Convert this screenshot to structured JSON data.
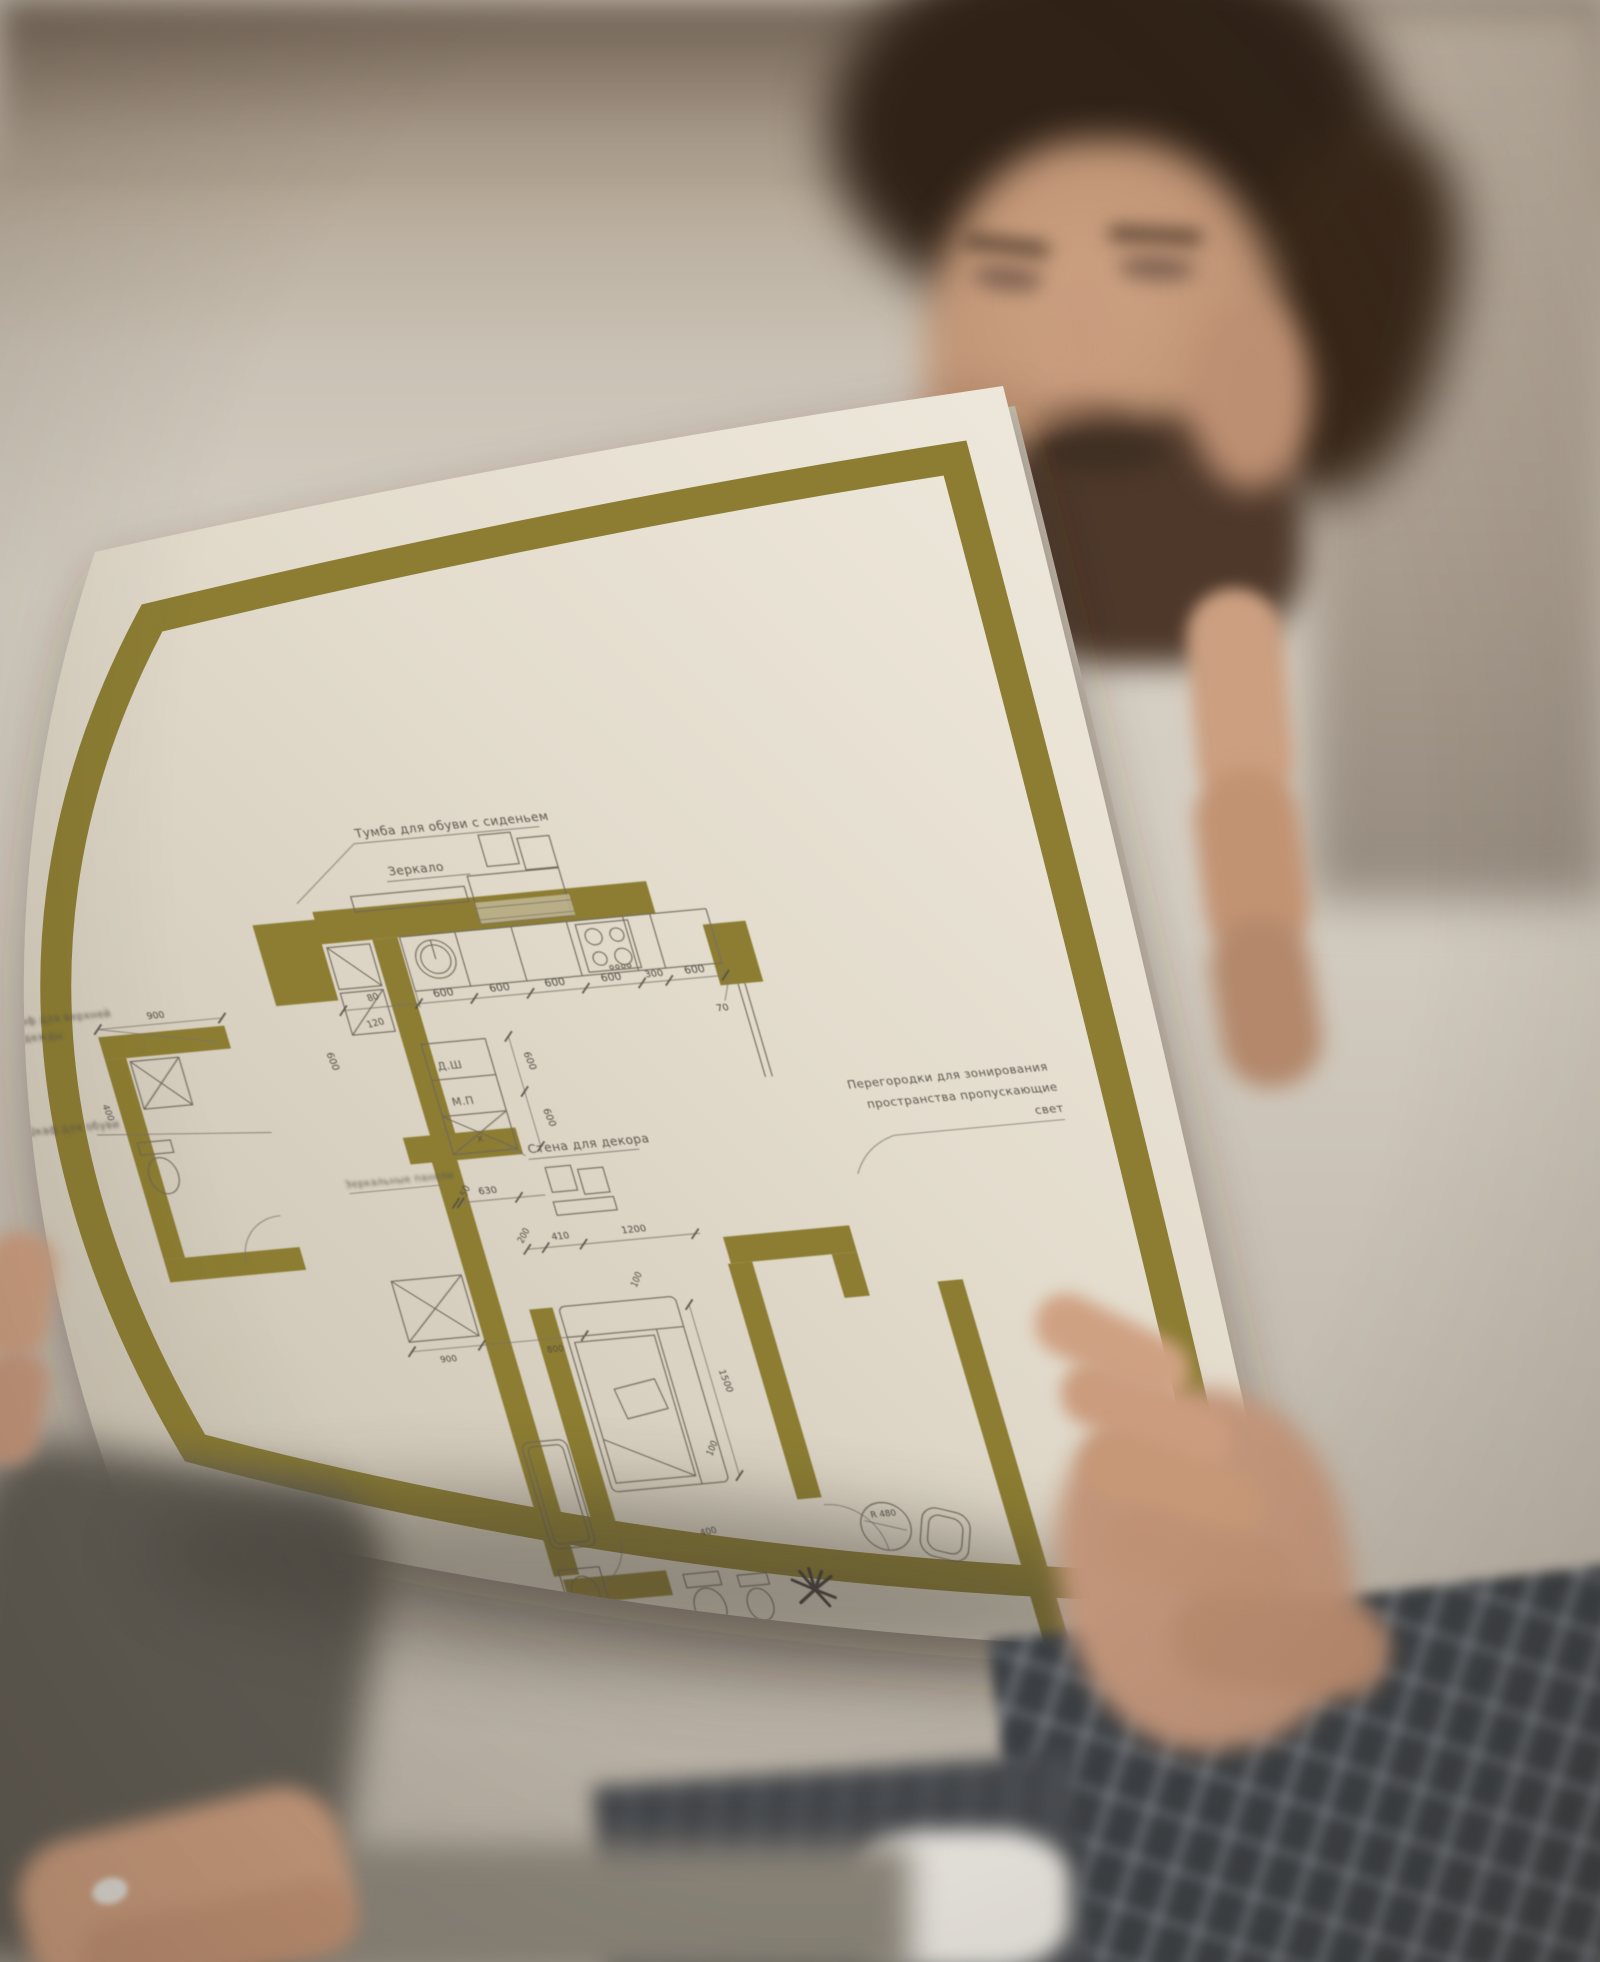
{
  "colors": {
    "frame_olive": "#8c7d33",
    "paper_light": "#f0eadf",
    "paper_dark": "#c9c1b1"
  },
  "blueprint": {
    "labels": {
      "shoe_cabinet": "Тумба для обуви с сиденьем",
      "mirror": "Зеркало",
      "left_note_1a": "Шкаф для верхней",
      "left_note_1b": "одежды",
      "left_note_2": "Шкаф для обуви",
      "closet_dsh": "Д.Ш",
      "closet_mp": "М.П",
      "closet_x": "х",
      "decor_wall": "Стена для декора",
      "mirror_panels": "Зеркальные панели",
      "partition_line1": "Перегородки для зонирования",
      "partition_line2": "пространства пропускающие",
      "partition_line3": "свет",
      "dressing_table": "Туалетный столик",
      "table_radius": "R 480"
    },
    "dims": {
      "kitchen_run": [
        "600",
        "600",
        "600",
        "600",
        "300",
        "600"
      ],
      "kitchen_end": "70",
      "hall_small": [
        "80",
        "120"
      ],
      "hall_left": "600",
      "closet_vertical": [
        "600",
        "600"
      ],
      "decor": [
        "50",
        "630"
      ],
      "corridor_run": [
        "200",
        "410",
        "1200"
      ],
      "corridor_boxes": [
        "900",
        "800"
      ],
      "wc_top": "900",
      "wc_side": "400",
      "sofa_side": [
        "100",
        "100",
        "1500"
      ],
      "bath_fixture": "400"
    }
  }
}
